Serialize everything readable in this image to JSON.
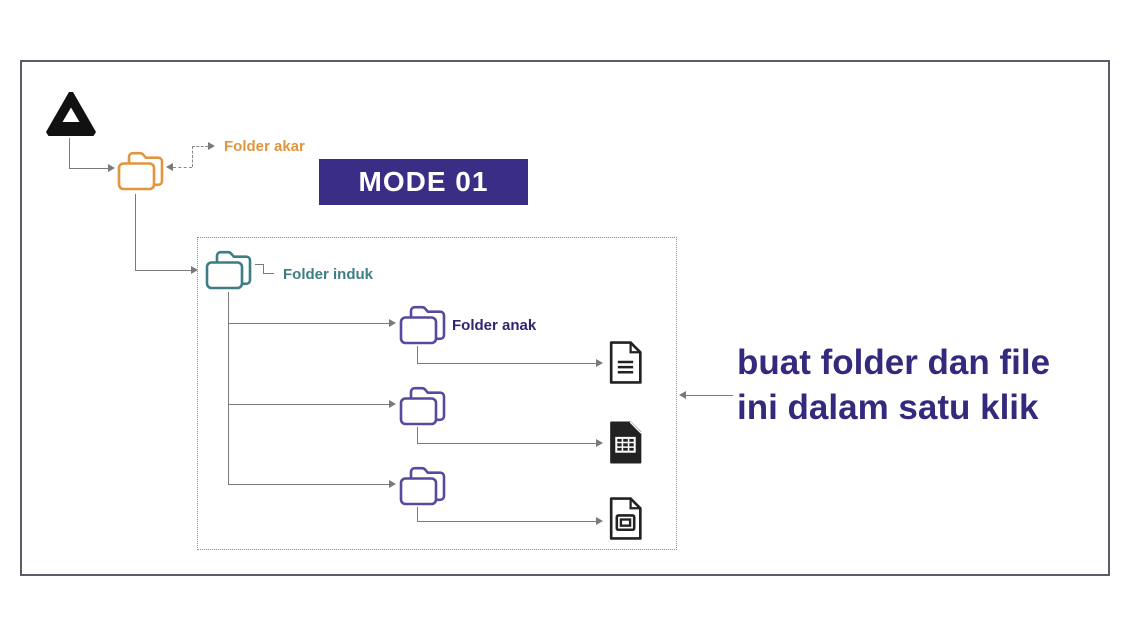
{
  "mode_banner": {
    "label": "MODE 01",
    "bg_color": "#3a2d86",
    "text_color": "#ffffff"
  },
  "labels": {
    "root_folder": "Folder akar",
    "parent_folder": "Folder induk",
    "child_folder": "Folder anak"
  },
  "caption": {
    "line1": "buat folder dan file",
    "line2": "ini dalam satu klik",
    "color": "#342a7d"
  },
  "icons": {
    "drive": "google-drive-icon",
    "root_folder": "folder-icon",
    "parent_folder": "folder-icon",
    "child_folder": "folder-icon",
    "file1": "doc-file-icon",
    "file2": "spreadsheet-file-icon",
    "file3": "slides-file-icon"
  },
  "colors": {
    "root_folder": "#e2953d",
    "root_label": "#e0963e",
    "parent_folder": "#3d7e85",
    "child_folder": "#574a9d",
    "child_label": "#2f2670",
    "connector": "#7a7a7a",
    "frame_border": "#5b5b6e"
  }
}
